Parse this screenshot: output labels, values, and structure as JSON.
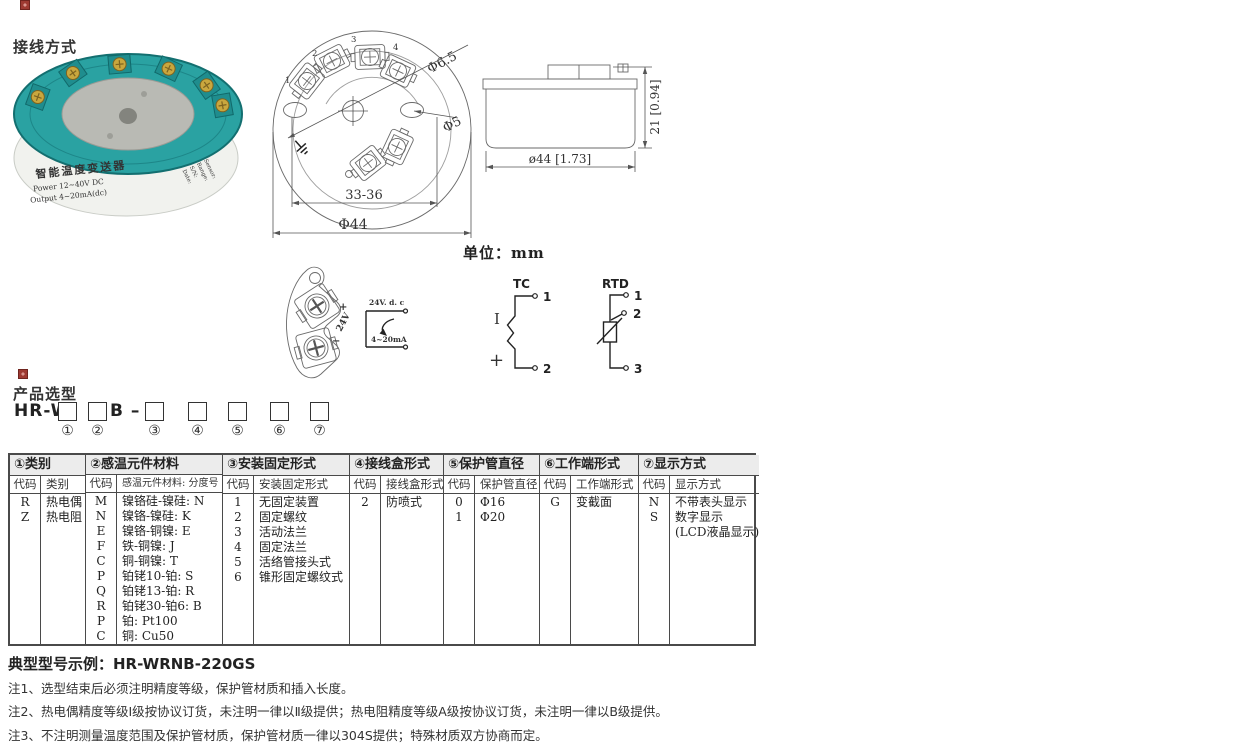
{
  "page": {
    "title1": "接线方式",
    "title2": "产品选型",
    "unit": "单位：mm",
    "example": "典型型号示例：HR-WRNB-220GS",
    "notes": [
      "注1、选型结束后必须注明精度等级，保护管材质和插入长度。",
      "注2、热电偶精度等级I级按协议订货，未注明一律以Ⅱ级提供；热电阻精度等级A级按协议订货，未注明一律以B级提供。",
      "注3、不注明测量温度范围及保护管材质，保护管材质一律以304S提供；特殊材质双方协商而定。"
    ]
  },
  "photo": {
    "name": "智能温度变送器",
    "line2": "Power  12~40V DC",
    "line3": "Output  4~20mA(dc)",
    "side": [
      "Sensor:",
      "Range:",
      "S/N:",
      "Date:"
    ]
  },
  "top_view": {
    "terminals": [
      "1",
      "2",
      "3",
      "4"
    ],
    "dim_hole_large": "Φ6.5",
    "dim_hole_small": "Φ5",
    "dim_span": "33-36",
    "dim_outer": "Φ44"
  },
  "side_view": {
    "dim_height": "21 [0.94]",
    "dim_width": "ø44 [1.73]"
  },
  "wiring": {
    "plus": "+",
    "minus": "−",
    "supply": "24V",
    "loop_supply": "24V. d. c",
    "loop_current": "4~20mA",
    "tc": {
      "title": "TC",
      "neg": "I",
      "pos": "+",
      "pin1": "1",
      "pin2": "2"
    },
    "rtd": {
      "title": "RTD",
      "pin1": "1",
      "pin2": "2",
      "pin3": "3"
    }
  },
  "model": {
    "prefix": "HR-W",
    "mid": "B –",
    "positions": [
      "①",
      "②",
      "③",
      "④",
      "⑤",
      "⑥",
      "⑦"
    ]
  },
  "selection_table": {
    "columns": [
      {
        "title": "①类别",
        "headers": [
          "代码",
          "类别"
        ],
        "rows": [
          [
            "R",
            "热电偶"
          ],
          [
            "Z",
            "热电阻"
          ]
        ]
      },
      {
        "title": "②感温元件材料",
        "headers": [
          "代码",
          "感温元件材料: 分度号"
        ],
        "rows": [
          [
            "M",
            "镍铬硅-镍硅: N"
          ],
          [
            "N",
            "镍铬-镍硅: K"
          ],
          [
            "E",
            "镍铬-铜镍: E"
          ],
          [
            "F",
            "铁-铜镍: J"
          ],
          [
            "C",
            "铜-铜镍: T"
          ],
          [
            "P",
            "铂铑10-铂: S"
          ],
          [
            "Q",
            "铂铑13-铂: R"
          ],
          [
            "R",
            "铂铑30-铂6: B"
          ],
          [
            "P",
            "铂: Pt100"
          ],
          [
            "C",
            "铜: Cu50"
          ]
        ]
      },
      {
        "title": "③安装固定形式",
        "headers": [
          "代码",
          "安装固定形式"
        ],
        "rows": [
          [
            "1",
            "无固定装置"
          ],
          [
            "2",
            "固定螺纹"
          ],
          [
            "3",
            "活动法兰"
          ],
          [
            "4",
            "固定法兰"
          ],
          [
            "5",
            "活络管接头式"
          ],
          [
            "6",
            "锥形固定螺纹式"
          ]
        ]
      },
      {
        "title": "④接线盒形式",
        "headers": [
          "代码",
          "接线盒形式"
        ],
        "rows": [
          [
            "2",
            "防喷式"
          ]
        ]
      },
      {
        "title": "⑤保护管直径",
        "headers": [
          "代码",
          "保护管直径"
        ],
        "rows": [
          [
            "0",
            "Φ16"
          ],
          [
            "1",
            "Φ20"
          ]
        ]
      },
      {
        "title": "⑥工作端形式",
        "headers": [
          "代码",
          "工作端形式"
        ],
        "rows": [
          [
            "G",
            "变截面"
          ]
        ]
      },
      {
        "title": "⑦显示方式",
        "headers": [
          "代码",
          "显示方式"
        ],
        "rows": [
          [
            "N",
            "不带表头显示"
          ],
          [
            "S",
            "数字显示"
          ],
          [
            "",
            "(LCD液晶显示)"
          ]
        ]
      }
    ]
  }
}
